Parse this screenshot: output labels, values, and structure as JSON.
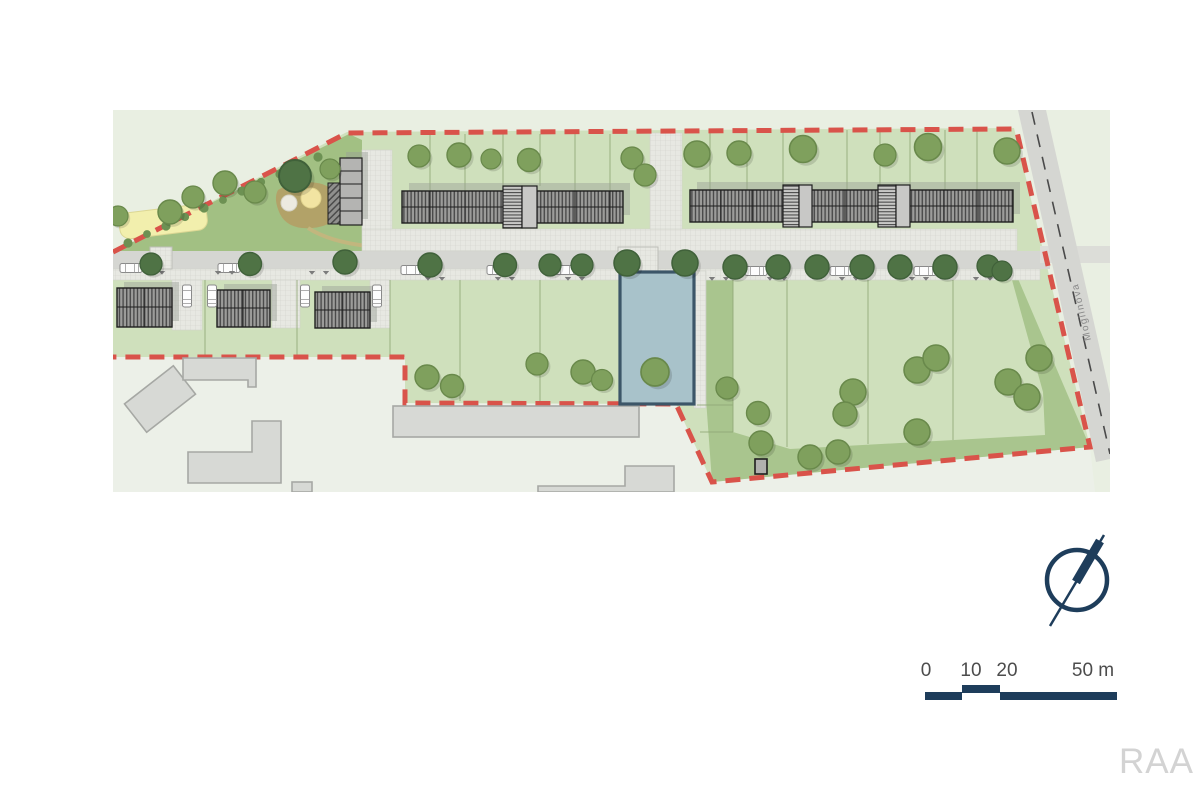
{
  "page": {
    "logo": "RAA"
  },
  "plan": {
    "street_label": "Mogilnova"
  },
  "scale_bar": {
    "labels": [
      "0",
      "10",
      "20",
      "50 m"
    ]
  },
  "colors": {
    "map_bg": "#e9efe2",
    "town_tint": "#ecf0e8",
    "site_green": "#cfe0bc",
    "park_green": "#a2c083",
    "olive_green": "#a9c58e",
    "road_gray": "#d5d6d2",
    "road_stub": "#dcddd8",
    "paving": "#e7e8e2",
    "paving_line": "#d1d2cb",
    "roof_gray": "#9c9c9a",
    "roof_line": "#4b4b4b",
    "building_outline": "#1e1e1e",
    "stair_fill": "#c8c8c6",
    "existing_fill": "#d7d9d5",
    "existing_outline": "#a6a8a4",
    "tree_fill": "#7fa05d",
    "tree_stroke": "#69894b",
    "street_tree_fill": "#4f7345",
    "street_tree_stroke": "#40613a",
    "bush": "#6d9153",
    "boundary_red": "#d9534a",
    "plot_fill": "#a8c2ca",
    "plot_stroke": "#3c5668",
    "navy": "#1e3d5b",
    "scale_text": "#4c4c4c",
    "logo_gray": "#d3d3d3",
    "street_label": "#8a8a8a",
    "sand_yellow": "#f2efad",
    "playground_tan": "#b2a268",
    "shadow": "#98a096",
    "parcel_line": "#8fa775",
    "shed": "#b1b1ae"
  }
}
